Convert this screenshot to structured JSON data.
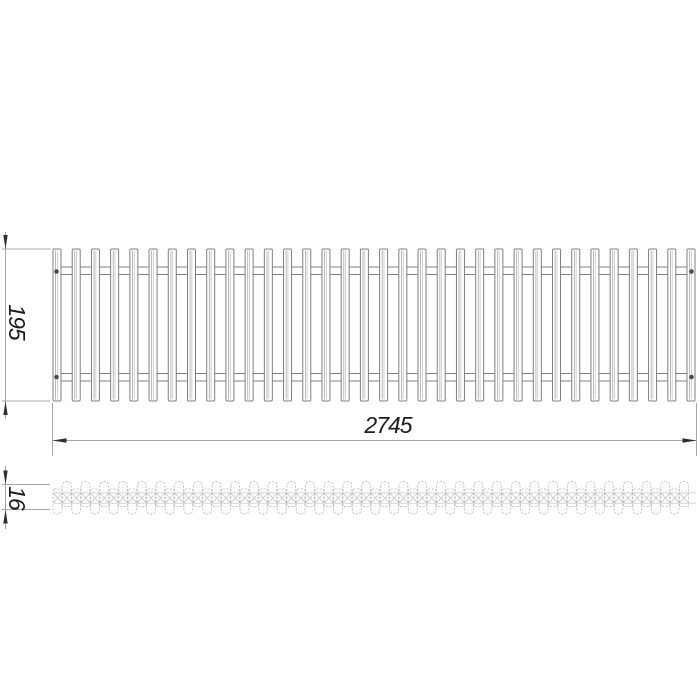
{
  "page": {
    "background": "#ffffff"
  },
  "drawing": {
    "views": {
      "plan": {
        "slat_count": 34,
        "rail_count": 2,
        "screw_count": 4
      },
      "section": {
        "element_rows": 2
      }
    },
    "dimensions": {
      "length": {
        "value": "2745"
      },
      "height": {
        "value": "195"
      },
      "thickness": {
        "value": "16"
      }
    },
    "colors": {
      "line": "#7f7f7f",
      "slat_inner_dark": "#a8a8a8",
      "slat_inner_light": "#c6c6c6",
      "dim_line": "#a3a8a8",
      "arrow": "#2f2f2f",
      "text": "#1c1c1c",
      "section_line": "#b9bdbd",
      "section_fill": "#ffffff",
      "stipple_dot": "#d8dada"
    }
  }
}
